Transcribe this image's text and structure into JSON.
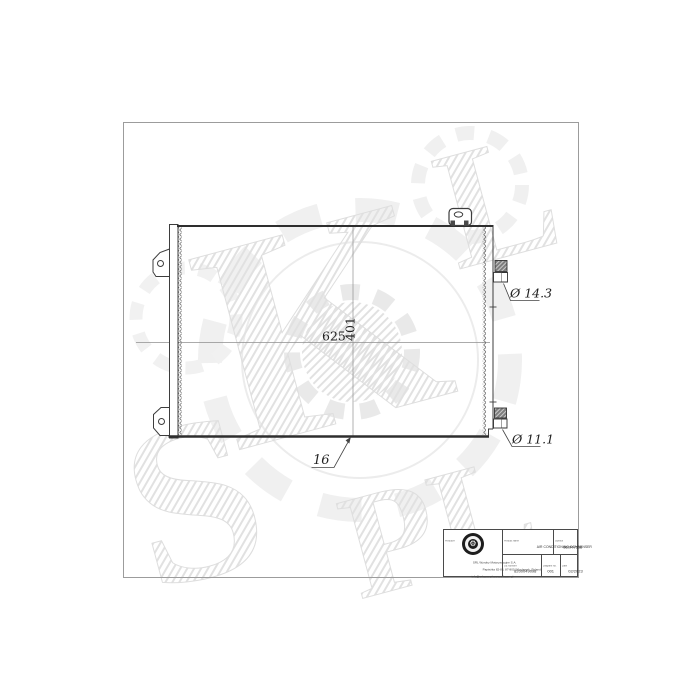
{
  "drawing": {
    "dimensions": {
      "width": "625",
      "height": "401",
      "thickness": "16",
      "inlet_diameter": "Ø 14.3",
      "outlet_diameter": "Ø 11.1"
    }
  },
  "watermark": {
    "letters": [
      "S",
      "K",
      "L",
      "PL"
    ]
  },
  "title_block": {
    "producer": {
      "label": "Producer",
      "address_line1": "SRL Wyroby Motoryzacyjne S.A.",
      "address_line2": "Papieżka 82-85, 87-800 Włocławek, Poland",
      "address_line3": "info@srl.com.pl  www.srl.com.pl"
    },
    "product_name": {
      "label": "Product name",
      "value": "AIR CONDITIONING CONDENSER"
    },
    "symbol": {
      "label": "Symbol",
      "value": "860RV558"
    },
    "oe_number": {
      "label": "OE Number",
      "value": "8200049098"
    },
    "diagram_no": {
      "label": "Diagram No.",
      "value": "001"
    },
    "date": {
      "label": "Date",
      "value": "02/2023"
    }
  }
}
